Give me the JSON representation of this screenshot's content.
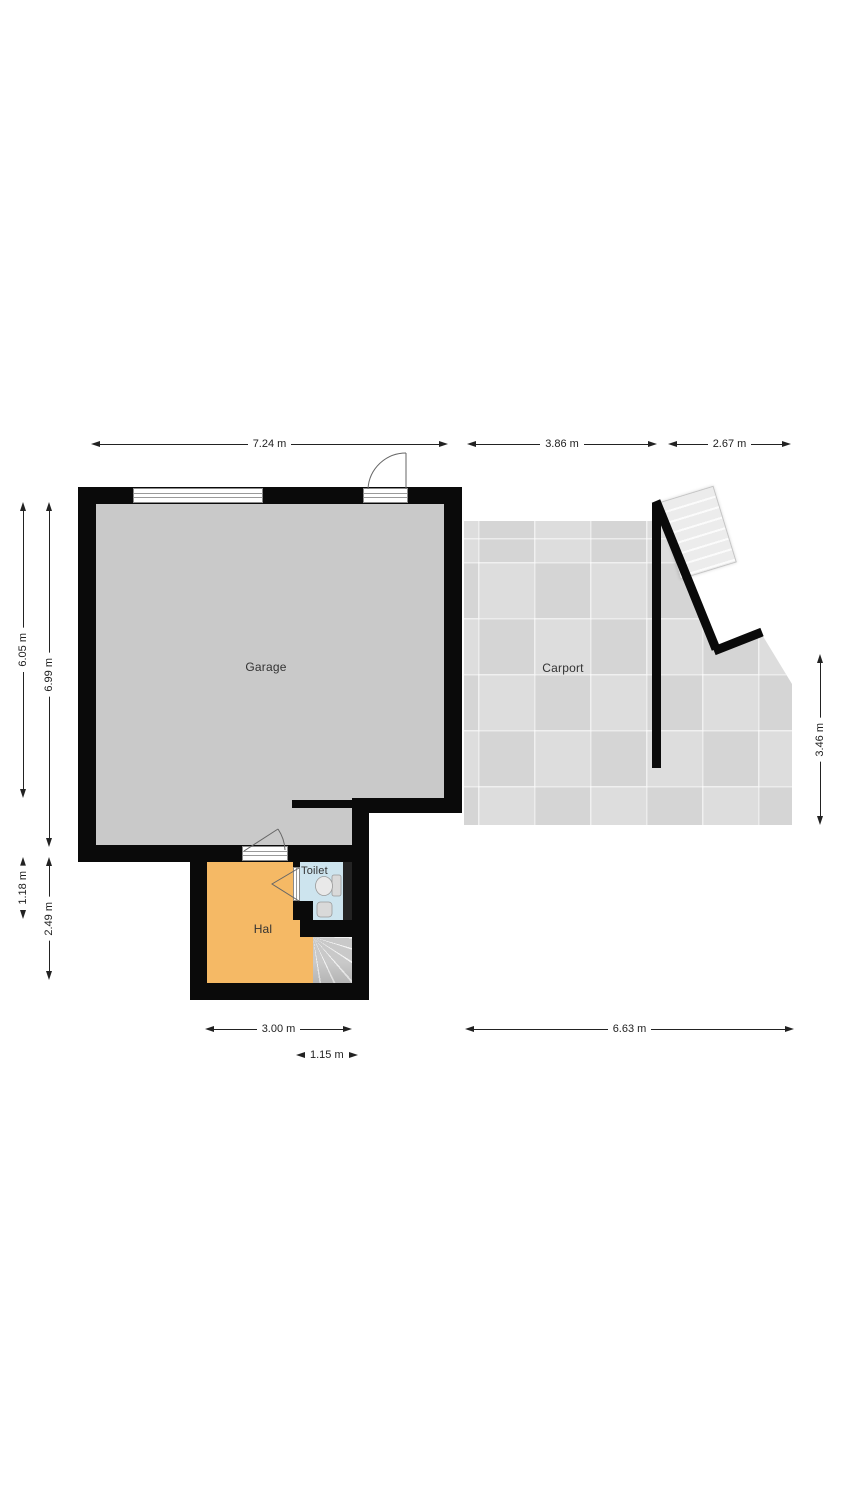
{
  "floorplan": {
    "rooms": {
      "garage": {
        "label": "Garage"
      },
      "carport": {
        "label": "Carport"
      },
      "hal": {
        "label": "Hal"
      },
      "toilet": {
        "label": "Toilet"
      }
    },
    "dimensions": {
      "top": [
        {
          "label": "7.24 m"
        },
        {
          "label": "3.86 m"
        },
        {
          "label": "2.67 m"
        }
      ],
      "left": [
        {
          "label": "6.05 m"
        },
        {
          "label": "6.99 m"
        },
        {
          "label": "1.18 m"
        },
        {
          "label": "2.49 m"
        }
      ],
      "right": [
        {
          "label": "3.46 m"
        }
      ],
      "bottom": [
        {
          "label": "3.00 m"
        },
        {
          "label": "6.63 m"
        },
        {
          "label": "1.15 m"
        }
      ]
    },
    "colors": {
      "wall": "#0a0a0a",
      "garage_floor": "#c9c9c9",
      "carport_floor": "#dcdcdc",
      "hal_floor": "#f5b965",
      "toilet_floor": "#cde4ee",
      "stairs": "#ececec",
      "dimension_text": "#222222"
    }
  }
}
